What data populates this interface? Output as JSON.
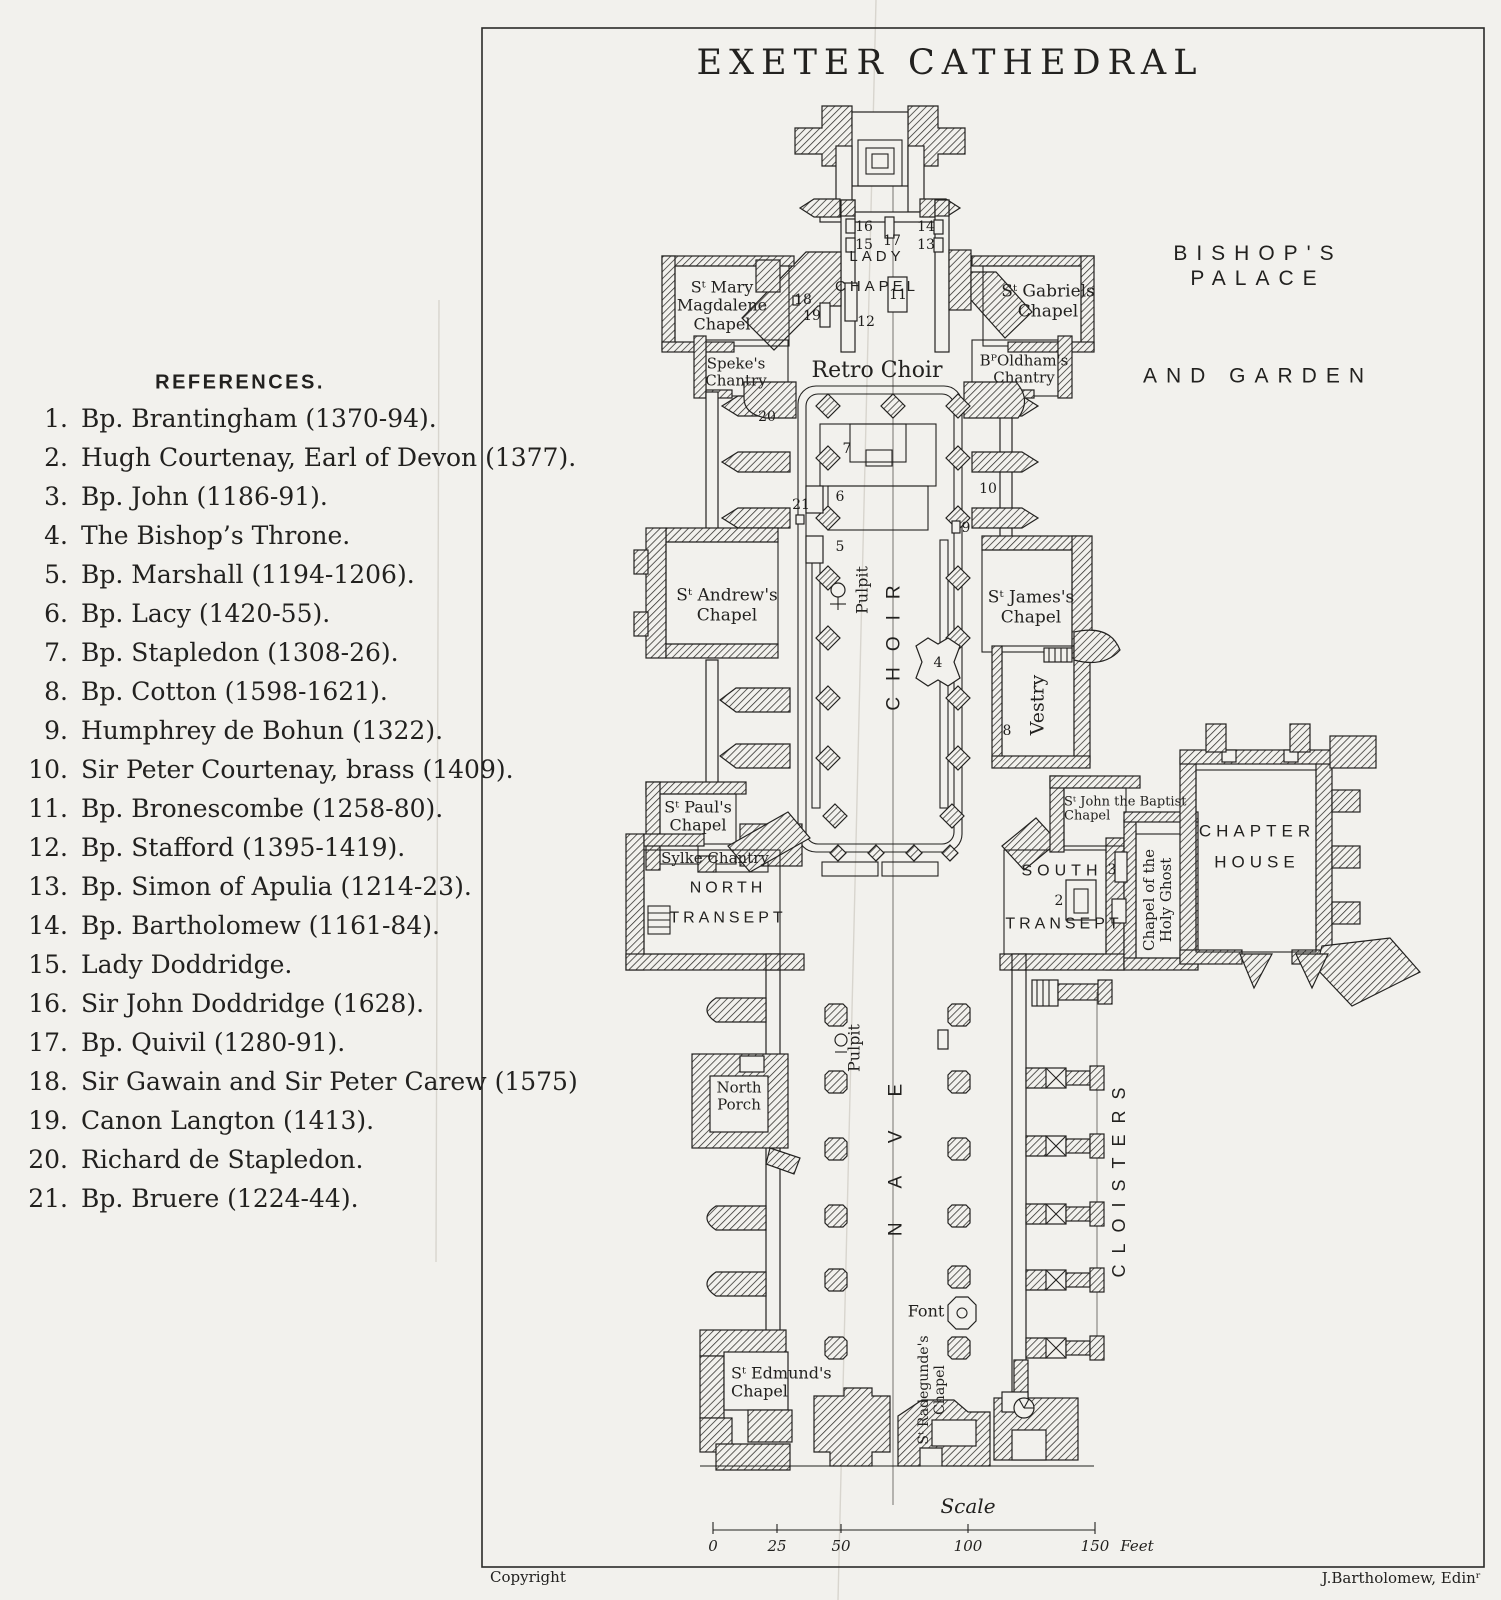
{
  "main": {
    "title": "EXETER CATHEDRAL"
  },
  "references": {
    "heading": "REFERENCES.",
    "items": [
      {
        "num": "1.",
        "text": "Bp. Brantingham (1370-94)."
      },
      {
        "num": "2.",
        "text": "Hugh Courtenay, Earl of Devon (1377)."
      },
      {
        "num": "3.",
        "text": "Bp. John (1186-91)."
      },
      {
        "num": "4.",
        "text": "The Bishop’s Throne."
      },
      {
        "num": "5.",
        "text": "Bp. Marshall (1194-1206)."
      },
      {
        "num": "6.",
        "text": "Bp. Lacy (1420-55)."
      },
      {
        "num": "7.",
        "text": "Bp. Stapledon (1308-26)."
      },
      {
        "num": "8.",
        "text": "Bp. Cotton (1598-1621)."
      },
      {
        "num": "9.",
        "text": "Humphrey de Bohun (1322)."
      },
      {
        "num": "10.",
        "text": "Sir Peter Courtenay, brass (1409)."
      },
      {
        "num": "11.",
        "text": "Bp. Bronescombe (1258-80)."
      },
      {
        "num": "12.",
        "text": "Bp. Stafford (1395-1419)."
      },
      {
        "num": "13.",
        "text": "Bp. Simon of Apulia (1214-23)."
      },
      {
        "num": "14.",
        "text": "Bp. Bartholomew (1161-84)."
      },
      {
        "num": "15.",
        "text": "Lady Doddridge."
      },
      {
        "num": "16.",
        "text": "Sir John Doddridge (1628)."
      },
      {
        "num": "17.",
        "text": "Bp. Quivil (1280-91)."
      },
      {
        "num": "18.",
        "text": "Sir Gawain and Sir Peter Carew (1575)"
      },
      {
        "num": "19.",
        "text": "Canon Langton (1413)."
      },
      {
        "num": "20.",
        "text": "Richard de Stapledon."
      },
      {
        "num": "21.",
        "text": "Bp. Bruere (1224-44)."
      }
    ]
  },
  "plan_labels": [
    {
      "id": "lady-chapel",
      "text": "LADY\nCHAPEL",
      "x": 877,
      "y": 272,
      "font": "sans",
      "size": 15,
      "ls": 4,
      "lh": 2.0
    },
    {
      "id": "st-mary-magdalene-chapel",
      "text": "Sᵗ Mary\nMagdalene\nChapel",
      "x": 722,
      "y": 306,
      "font": "serif",
      "size": 16,
      "lh": 1.15
    },
    {
      "id": "st-gabriels-chapel",
      "text": "Sᵗ Gabriels\nChapel",
      "x": 1048,
      "y": 302,
      "font": "serif",
      "size": 17,
      "lh": 1.15
    },
    {
      "id": "spekes-chantry",
      "text": "Speke's\nChantry",
      "x": 736,
      "y": 372,
      "font": "serif",
      "size": 15,
      "lh": 1.1
    },
    {
      "id": "retro-choir",
      "text": "Retro Choir",
      "x": 877,
      "y": 371,
      "font": "serif",
      "size": 22
    },
    {
      "id": "bp-oldhams-chantry",
      "text": "BᴾOldham's\nChantry",
      "x": 1024,
      "y": 369,
      "font": "serif",
      "size": 15,
      "lh": 1.1
    },
    {
      "id": "bishops-palace",
      "text": "BISHOP'S PALACE",
      "x": 1258,
      "y": 266,
      "font": "sans",
      "size": 21,
      "ls": 9
    },
    {
      "id": "and-garden",
      "text": "AND GARDEN",
      "x": 1258,
      "y": 376,
      "font": "sans",
      "size": 21,
      "ls": 9
    },
    {
      "id": "st-andrews-chapel",
      "text": "Sᵗ Andrew's\nChapel",
      "x": 727,
      "y": 606,
      "font": "serif",
      "size": 17,
      "lh": 1.15
    },
    {
      "id": "st-jamess-chapel",
      "text": "Sᵗ James's\nChapel",
      "x": 1031,
      "y": 608,
      "font": "serif",
      "size": 17,
      "lh": 1.15
    },
    {
      "id": "pulpit-choir",
      "text": "Pulpit",
      "x": 862,
      "y": 590,
      "font": "serif",
      "size": 16,
      "rot": true
    },
    {
      "id": "choir",
      "text": "CHOIR",
      "x": 895,
      "y": 640,
      "font": "sans",
      "size": 19,
      "ls": 16,
      "rot": true
    },
    {
      "id": "vestry",
      "text": "Vestry",
      "x": 1038,
      "y": 705,
      "font": "serif",
      "size": 19,
      "rot": true
    },
    {
      "id": "st-pauls-chapel",
      "text": "Sᵗ Paul's\nChapel",
      "x": 698,
      "y": 816,
      "font": "serif",
      "size": 16,
      "lh": 1.1
    },
    {
      "id": "sylke-chantry",
      "text": "Sylke Chantry",
      "x": 715,
      "y": 858,
      "font": "serif",
      "size": 15
    },
    {
      "id": "north-transept",
      "text": "NORTH\nTRANSEPT",
      "x": 728,
      "y": 903,
      "font": "sans",
      "size": 16,
      "ls": 4,
      "lh": 1.85
    },
    {
      "id": "south-transept-line1",
      "text": "SOUTH",
      "x": 1062,
      "y": 871,
      "font": "sans",
      "size": 16,
      "ls": 5
    },
    {
      "id": "south-transept-line2",
      "text": "TRANSEPT",
      "x": 1064,
      "y": 924,
      "font": "sans",
      "size": 16,
      "ls": 4
    },
    {
      "id": "st-john-the-baptist-chapel",
      "text": "Sᵗ John the Baptist\nChapel",
      "x": 1064,
      "y": 810,
      "font": "serif",
      "size": 13,
      "lh": 1.1,
      "align": "left"
    },
    {
      "id": "chapel-of-the-holy-ghost",
      "text": "Chapel of the\nHoly Ghost",
      "x": 1158,
      "y": 900,
      "font": "serif",
      "size": 15,
      "rot": true,
      "lh": 1.15
    },
    {
      "id": "chapter-house",
      "text": "CHAPTER\nHOUSE",
      "x": 1257,
      "y": 847,
      "font": "sans",
      "size": 17,
      "ls": 5,
      "lh": 1.85
    },
    {
      "id": "nave",
      "text": "NAVE",
      "x": 897,
      "y": 1143,
      "font": "sans",
      "size": 19,
      "ls": 34,
      "rot": true
    },
    {
      "id": "pulpit-nave",
      "text": "Pulpit",
      "x": 854,
      "y": 1048,
      "font": "serif",
      "size": 16,
      "rot": true
    },
    {
      "id": "north-porch",
      "text": "North\nPorch",
      "x": 739,
      "y": 1096,
      "font": "serif",
      "size": 15,
      "lh": 1.1
    },
    {
      "id": "cloisters",
      "text": "CLOISTERS",
      "x": 1120,
      "y": 1177,
      "font": "sans",
      "size": 18,
      "ls": 11,
      "rot": true
    },
    {
      "id": "font",
      "text": "Font",
      "x": 926,
      "y": 1311,
      "font": "serif",
      "size": 16
    },
    {
      "id": "st-edmunds-chapel",
      "text": "Sᵗ Edmund's\nChapel",
      "x": 731,
      "y": 1382,
      "font": "serif",
      "size": 16,
      "lh": 1.1,
      "align": "left"
    },
    {
      "id": "st-radegundes-chapel",
      "text": "Sᵗ Radegunde's\nChapel",
      "x": 932,
      "y": 1390,
      "font": "serif",
      "size": 14,
      "rot": true,
      "lh": 1.15
    },
    {
      "id": "scale-title",
      "text": "Scale",
      "x": 968,
      "y": 1506,
      "font": "script",
      "size": 20
    }
  ],
  "plan_numbers": [
    {
      "n": "16",
      "x": 864,
      "y": 227
    },
    {
      "n": "15",
      "x": 864,
      "y": 245
    },
    {
      "n": "17",
      "x": 892,
      "y": 241
    },
    {
      "n": "14",
      "x": 926,
      "y": 227
    },
    {
      "n": "13",
      "x": 926,
      "y": 245
    },
    {
      "n": "18",
      "x": 803,
      "y": 300
    },
    {
      "n": "19",
      "x": 812,
      "y": 316
    },
    {
      "n": "12",
      "x": 866,
      "y": 322
    },
    {
      "n": "11",
      "x": 898,
      "y": 295
    },
    {
      "n": "20",
      "x": 767,
      "y": 417
    },
    {
      "n": "7",
      "x": 847,
      "y": 449
    },
    {
      "n": "21",
      "x": 801,
      "y": 505
    },
    {
      "n": "6",
      "x": 840,
      "y": 497
    },
    {
      "n": "5",
      "x": 840,
      "y": 547
    },
    {
      "n": "10",
      "x": 988,
      "y": 489
    },
    {
      "n": "9",
      "x": 966,
      "y": 528
    },
    {
      "n": "4",
      "x": 938,
      "y": 663
    },
    {
      "n": "8",
      "x": 1007,
      "y": 731
    },
    {
      "n": "3",
      "x": 1112,
      "y": 870
    },
    {
      "n": "2",
      "x": 1059,
      "y": 901
    }
  ],
  "scale_bar": {
    "ticks": [
      {
        "label": "0",
        "x": 713
      },
      {
        "label": "25",
        "x": 777
      },
      {
        "label": "50",
        "x": 841
      },
      {
        "label": "100",
        "x": 968
      },
      {
        "label": "150",
        "x": 1095
      }
    ],
    "unit": "Feet",
    "unit_x": 1137
  },
  "footer": {
    "left": "Copyright",
    "right": "J.Bartholomew, Edinʳ"
  },
  "colors": {
    "paper": "#f2f1ed",
    "ink": "#22211f",
    "crease": "#d8d5ce"
  }
}
